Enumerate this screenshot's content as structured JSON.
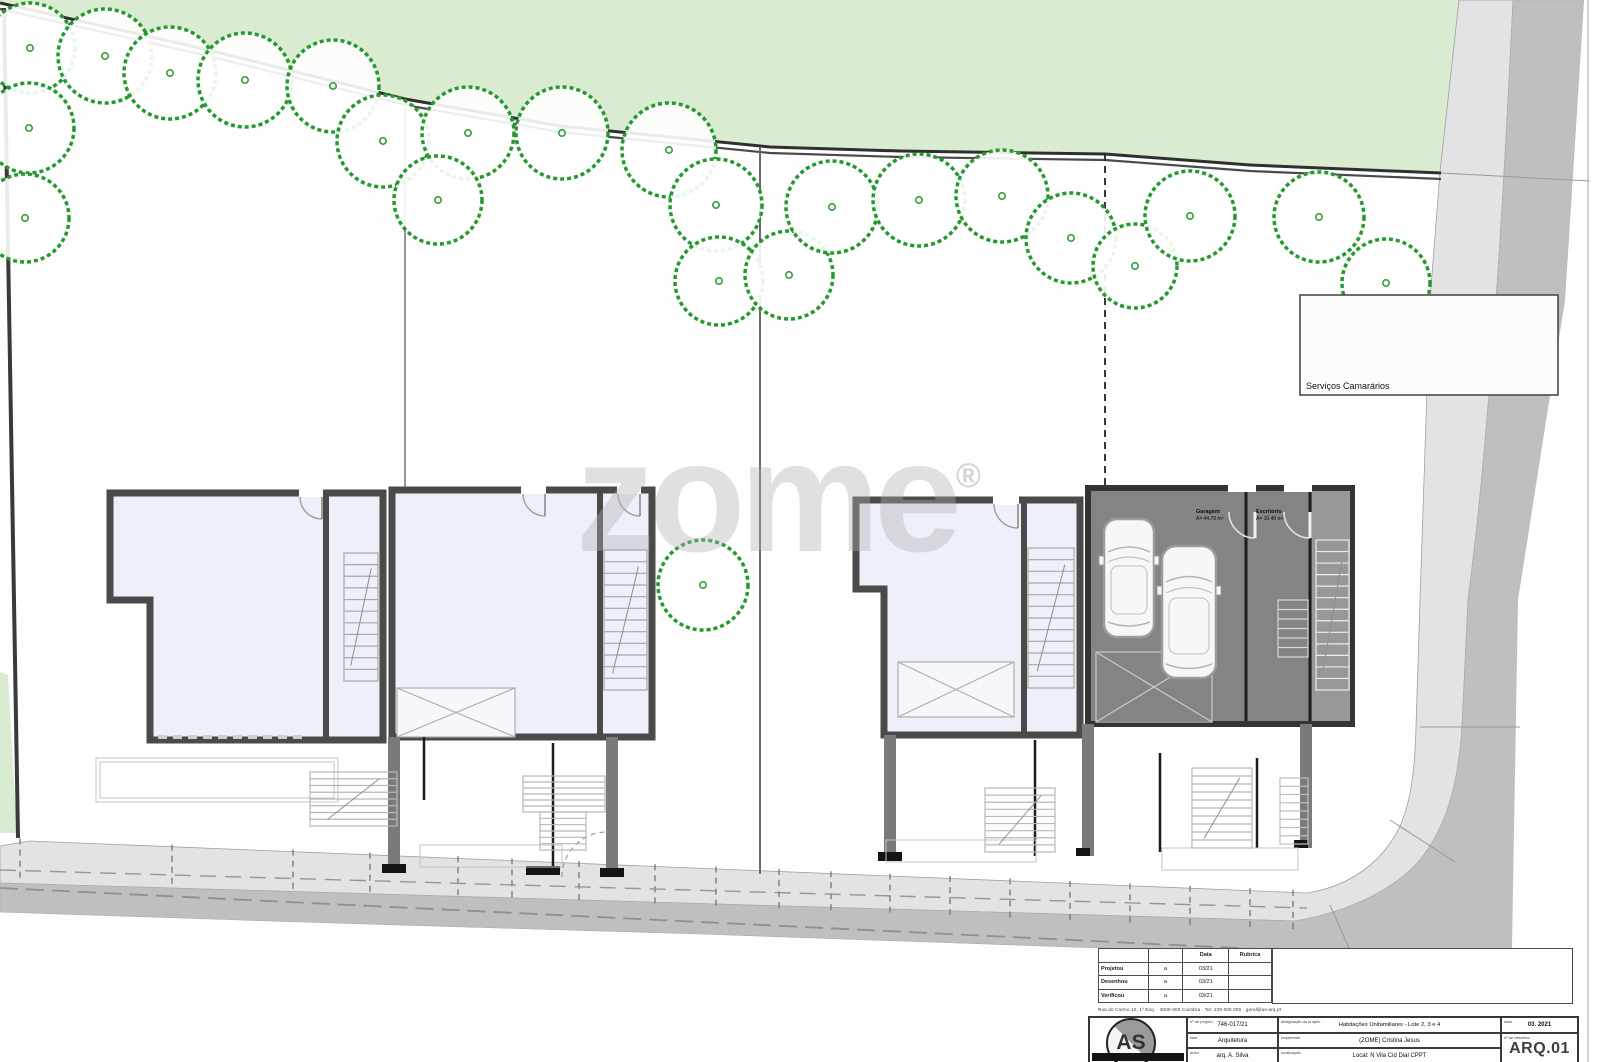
{
  "site": {
    "watermark": "zome",
    "watermark_reg": "®",
    "legend_note": "Serviços Camarários",
    "garage_room_label": "Garagem",
    "garage_room_area": "A= 44.70 m²",
    "office_room_label": "Escritório",
    "office_room_area": "A= 10.40 m²",
    "trees": [
      [
        30,
        48,
        45
      ],
      [
        105,
        56,
        47
      ],
      [
        170,
        73,
        46
      ],
      [
        245,
        80,
        47
      ],
      [
        333,
        86,
        46
      ],
      [
        29,
        128,
        45
      ],
      [
        383,
        141,
        46
      ],
      [
        25,
        218,
        44
      ],
      [
        468,
        133,
        46
      ],
      [
        562,
        133,
        46
      ],
      [
        438,
        200,
        44
      ],
      [
        669,
        150,
        47
      ],
      [
        716,
        205,
        46
      ],
      [
        719,
        281,
        44
      ],
      [
        789,
        275,
        44
      ],
      [
        832,
        207,
        46
      ],
      [
        919,
        200,
        46
      ],
      [
        1002,
        196,
        46
      ],
      [
        1071,
        238,
        45
      ],
      [
        1135,
        266,
        42
      ],
      [
        1190,
        216,
        45
      ],
      [
        1319,
        217,
        45
      ],
      [
        1386,
        283,
        44
      ],
      [
        703,
        585,
        45
      ]
    ],
    "colors": {
      "green_area": "#d9ecd2",
      "tree_stroke": "#23992e",
      "room_fill": "#edeff9",
      "garage_fill": "#848484",
      "sidewalk": "#e3e3e3",
      "road": "#bfbfbf",
      "wall": "#4a4a4a"
    }
  },
  "revision_table": {
    "date_header": "Data",
    "rubric_header": "Rubrica",
    "rows": [
      {
        "label": "Projetou",
        "mark": "a",
        "date": "03/21",
        "rubric": ""
      },
      {
        "label": "Desenhou",
        "mark": "a",
        "date": "03/21",
        "rubric": ""
      },
      {
        "label": "Verificou",
        "mark": "a",
        "date": "03/21",
        "rubric": ""
      }
    ]
  },
  "title_block": {
    "address_line": "Rua do Carmo 12, 1º Esq. · 3000-000 Coimbra · Tel: 239 000 000 · geral@as-arq.pt",
    "logo_text": "AS",
    "proj_no_label": "nº de projeto",
    "proj_no": "746-017/21",
    "phase_label": "fase",
    "phase": "Arquitetura",
    "author_label": "autor",
    "author": "arq. A. Silva",
    "title_label": "designação do projeto",
    "title": "Habitações Unifamiliares - Lote 2, 3 e 4",
    "client_label": "requerente",
    "client": "(ZOME) Cristina Jesus",
    "location_label": "localização",
    "location": "Local: N Vila Cid Dial CPPT",
    "date_label": "data",
    "date": "03. 2021",
    "sheet_label": "nº de desenho",
    "sheet": "ARQ.01"
  }
}
